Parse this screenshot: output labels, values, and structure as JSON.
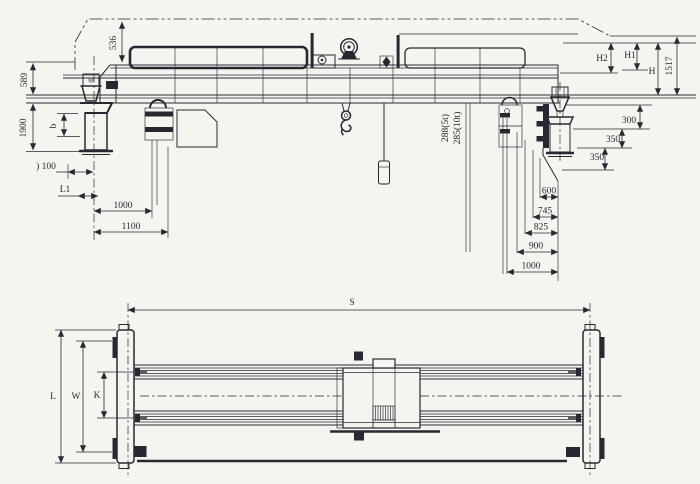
{
  "colors": {
    "ink": "#2a2733",
    "paper": "#f6f4ef"
  },
  "top_view": {
    "dims": {
      "v536": "536",
      "v589": "589",
      "v1900": "1900",
      "vb": "b",
      "v100": ") 100",
      "vL1": "L1",
      "v1000_left": "1000",
      "v1100": "1100",
      "v288": "288(5t)",
      "v285": "285(10t)",
      "vH2": "H2",
      "vH1": "H1",
      "vH": "H",
      "v1517": "1517",
      "v300": "300",
      "v350_upper": "350",
      "v350_lower": "350",
      "v600": "600",
      "v745": "745",
      "v825": "825",
      "v900": "900",
      "v1000_right": "1000"
    }
  },
  "bottom_view": {
    "dims": {
      "vS": "S",
      "vL": "L",
      "vW": "W",
      "vK": "K"
    }
  }
}
